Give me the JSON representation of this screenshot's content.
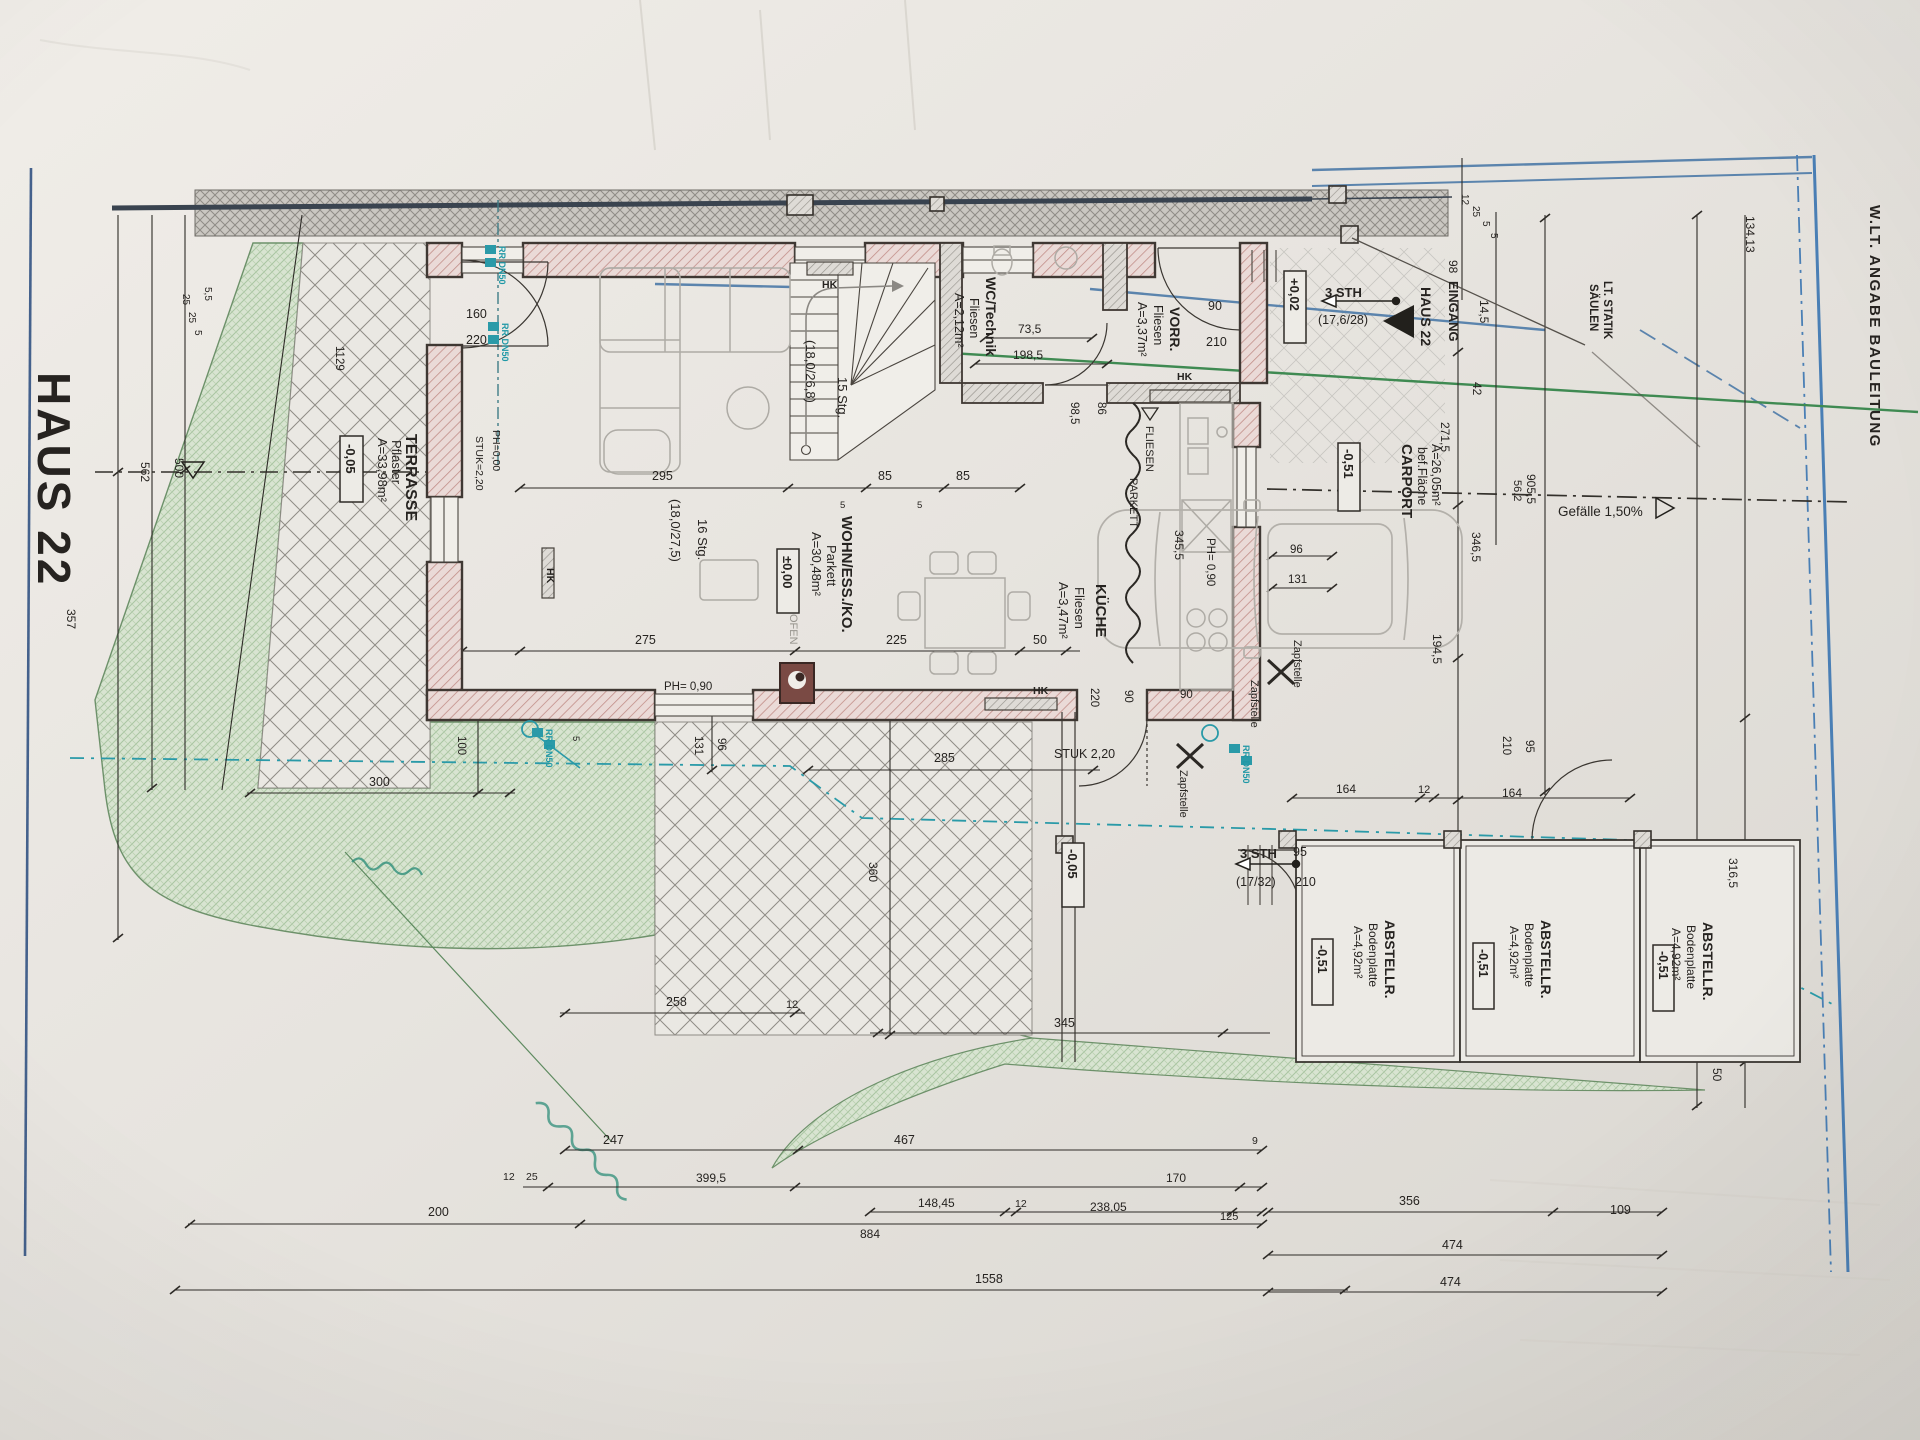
{
  "plan": {
    "sheet_title": "HAUS 22",
    "margin_note": "W.LT. ANGABE BAULEITUNG",
    "entry_marker": "HAUS 22",
    "entry_label": "EINGANG",
    "saeulen_line1": "SÄULEN",
    "saeulen_line2": "LT. STATIK",
    "slope": "Gefälle 1,50%"
  },
  "rooms": {
    "terrasse": {
      "name": "TERRASSE",
      "finish": "Pflaster",
      "area": "A=33,98m²",
      "level": "-0,05"
    },
    "wohn_ess_ko": {
      "name": "WOHN/ESS./KO.",
      "finish": "Parkett",
      "area": "A=30,48m²",
      "level": "±0,00"
    },
    "kueche": {
      "name": "KÜCHE",
      "finish": "Fliesen",
      "area": "A=3,47m²"
    },
    "wc_technik": {
      "name": "WC/Technik",
      "finish": "Fliesen",
      "area": "A=2,12m²"
    },
    "vorraum": {
      "name": "VORR.",
      "finish": "Fliesen",
      "area": "A=3,37m²"
    },
    "carport": {
      "name": "CARPORT",
      "finish": "bef.Fläche",
      "area": "A=26,05m²",
      "level": "-0,51"
    },
    "abstellraum": {
      "name": "ABSTELLR.",
      "finish": "Bodenplatte",
      "area": "A=4,92m²",
      "level": "-0,51"
    }
  },
  "levels": {
    "hof": "-0,05",
    "eingang": "+0,02"
  },
  "stairs": {
    "eg": {
      "steps": "16 Stg.",
      "ratio": "(18,0/27,5)"
    },
    "og": {
      "steps": "15 Stg.",
      "ratio": "(18,0/26,8)"
    },
    "entry": {
      "steps": "3 STH",
      "ratio": "(17,6/28)"
    },
    "hof": {
      "steps": "3 STH",
      "ratio": "(17/32)"
    }
  },
  "fixtures": {
    "ofen": "OFEN",
    "hk": "HK",
    "zapfstelle": "Zapfstelle",
    "rr_dn50": "RR DN50",
    "fliesen": "FLIESEN",
    "parkett": "PARKETT",
    "stuk_door": "STUK 2,20",
    "stuk_terrasse": "STUK=2,20",
    "ph_parapet": "PH= 0,90",
    "ph_zero": "PH=0,00"
  },
  "dims": {
    "d5": "5",
    "d5_5": "5,5",
    "d9": "9",
    "d12": "12",
    "d14_5": "14,5",
    "d25": "25",
    "d42": "42",
    "d50": "50",
    "d56_2": "56,2",
    "d73_5": "73,5",
    "d85": "85",
    "d86": "86",
    "d90": "90",
    "d95": "95",
    "d96": "96",
    "d98": "98",
    "d98_5": "98,5",
    "d100": "100",
    "d109": "109",
    "d125": "125",
    "d131": "131",
    "d134_13": "134,13",
    "d148_45": "148,45",
    "d160": "160",
    "d164": "164",
    "d170": "170",
    "d194_5": "194,5",
    "d198_5": "198,5",
    "d200": "200",
    "d210": "210",
    "d220": "220",
    "d225": "225",
    "d238_05": "238,05",
    "d247": "247",
    "d258": "258",
    "d271_5": "271,5",
    "d275": "275",
    "d285": "285",
    "d295": "295",
    "d300": "300",
    "d316_5": "316,5",
    "d345": "345",
    "d345_5": "345,5",
    "d346_5": "346,5",
    "d356": "356",
    "d357": "357",
    "d360": "360",
    "d399_5": "399,5",
    "d467": "467",
    "d474": "474",
    "d500": "500",
    "d562": "562",
    "d884": "884",
    "d905_5": "905,5",
    "d1129": "1129",
    "d1558": "1558"
  }
}
